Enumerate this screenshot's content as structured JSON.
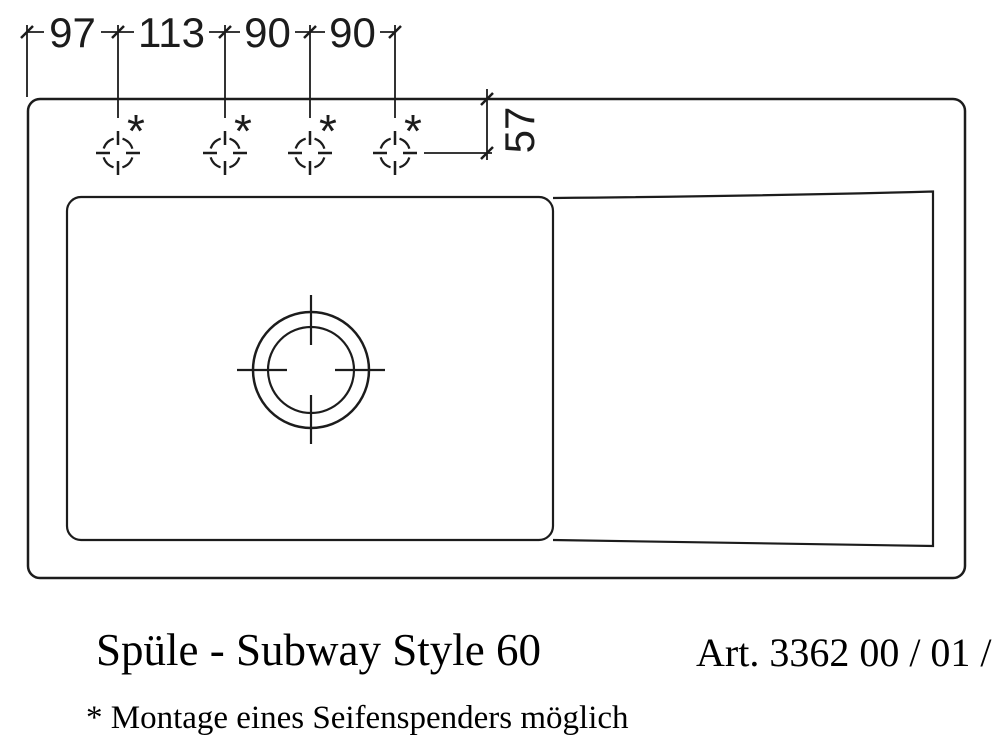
{
  "drawing": {
    "line_color": "#1c1c1c",
    "background_color": "#ffffff",
    "top_dimensions": [
      "97",
      "113",
      "90",
      "90"
    ],
    "side_dimension": "57",
    "hole_marker": "*"
  },
  "captions": {
    "title": "Spüle - Subway Style 60",
    "article_number": "Art. 3362 00 / 01 / 02",
    "footnote": "* Montage eines Seifenspenders möglich"
  }
}
